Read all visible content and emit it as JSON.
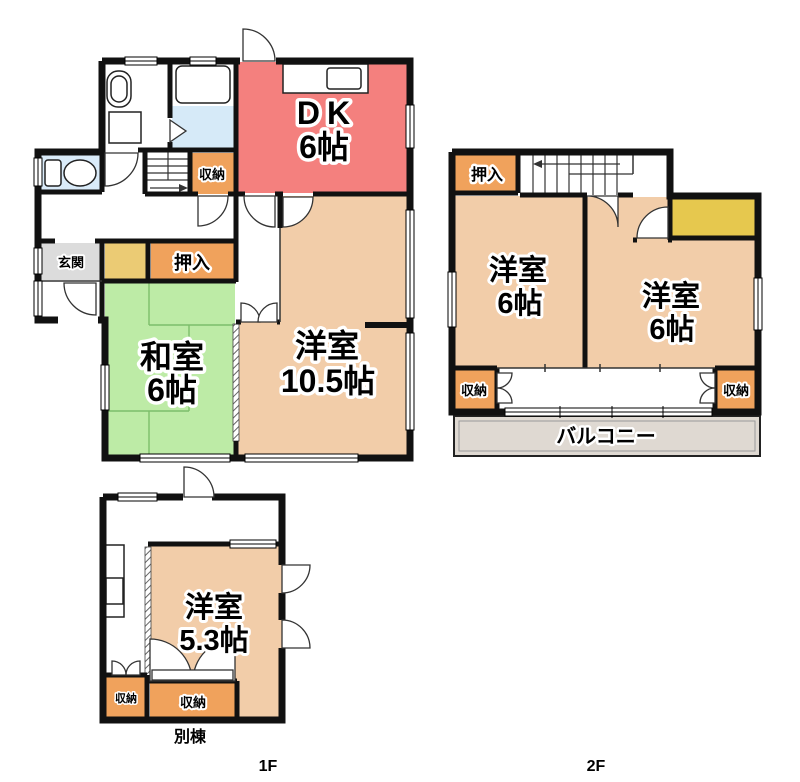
{
  "colors": {
    "wall": "#111111",
    "dk": "#F4807E",
    "western_room": "#F2CDA9",
    "tatami": "#BDEBA6",
    "tatami_line": "#7DBE6B",
    "closet_orange": "#F0A25C",
    "closet_yellow_1f": "#EBCB74",
    "closet_yellow_2f": "#E6C84E",
    "entrance": "#DCDCDC",
    "balcony": "#DFD9D2",
    "bath_room": "#D6EAF8",
    "bathtub": "#7BE8E6",
    "toilet_room": "#DAEBF9"
  },
  "floor1": {
    "rooms": {
      "dk": {
        "name": "DK",
        "size": "6帖"
      },
      "washitsu": {
        "name": "和室",
        "size": "6帖"
      },
      "yoshitsu": {
        "name": "洋室",
        "size": "10.5帖"
      }
    },
    "labels": {
      "shuno": "収納",
      "oshiire": "押入",
      "genkan": "玄関"
    }
  },
  "floor2": {
    "rooms": {
      "left": {
        "name": "洋室",
        "size": "6帖"
      },
      "right": {
        "name": "洋室",
        "size": "6帖"
      }
    },
    "labels": {
      "oshiire": "押入",
      "shuno_left": "収納",
      "shuno_right": "収納",
      "balcony": "バルコニー"
    }
  },
  "annex": {
    "rooms": {
      "yoshitsu": {
        "name": "洋室",
        "size": "5.3帖"
      }
    },
    "labels": {
      "shuno": "収納",
      "shuno_small": "収納"
    },
    "caption": "別棟"
  },
  "captions": {
    "f1": "1F",
    "f2": "2F"
  }
}
